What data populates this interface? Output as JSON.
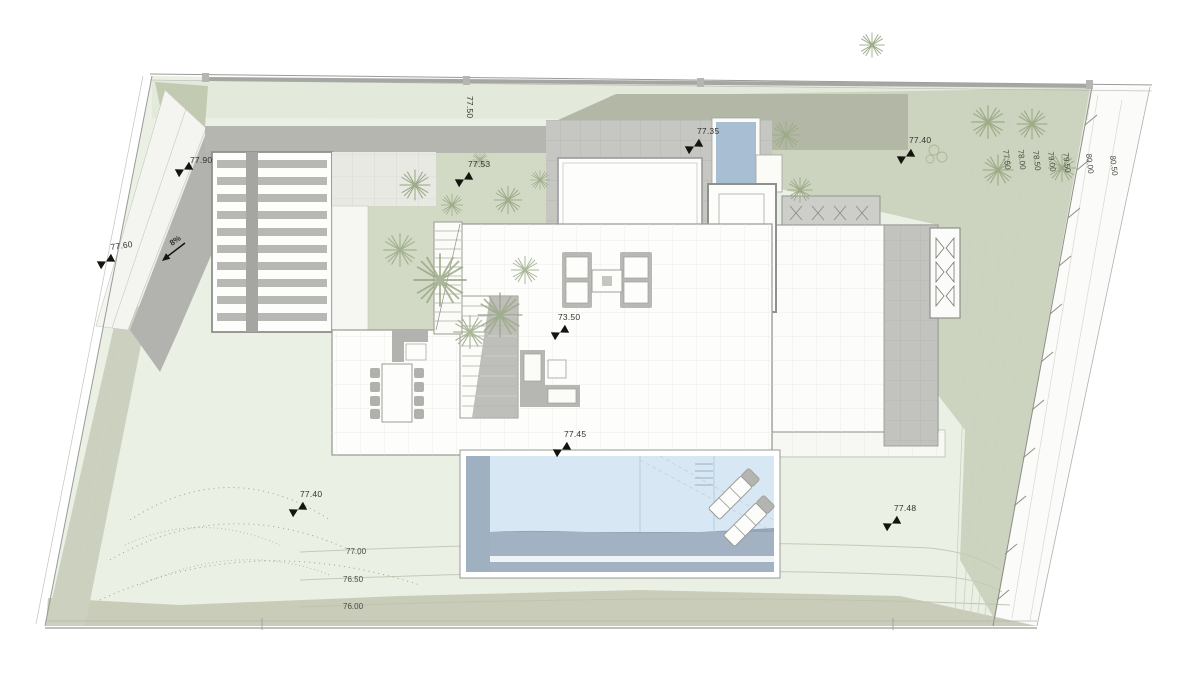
{
  "drawing": {
    "type": "architectural-site-plan",
    "street_level_label": "77.50",
    "slope_label": "8%",
    "spot_elevations": [
      {
        "label": "77.90"
      },
      {
        "label": "77.60"
      },
      {
        "label": "77.53"
      },
      {
        "label": "77.35"
      },
      {
        "label": "77.40"
      },
      {
        "label": "73.50"
      },
      {
        "label": "77.45"
      },
      {
        "label": "77.40"
      },
      {
        "label": "77.48"
      }
    ],
    "contour_labels_bottom": [
      {
        "label": "77.00"
      },
      {
        "label": "76.50"
      },
      {
        "label": "76.00"
      }
    ],
    "contour_labels_right": [
      {
        "label": "77.50"
      },
      {
        "label": "78.00"
      },
      {
        "label": "78.50"
      },
      {
        "label": "79.00"
      },
      {
        "label": "79.50"
      },
      {
        "label": "80.00"
      },
      {
        "label": "80.50"
      }
    ],
    "colors": {
      "lawn": "#eaf0e4",
      "lawn_top": "#e3eadb",
      "sage": "#ccd3bf",
      "courtyard": "#d2dac6",
      "water": "#d7e8f4",
      "water_deep": "#a2b2c2",
      "water_lap": "#a8bed2",
      "terrace": "#c6c6c2",
      "structure_gray": "#b6b6b1",
      "ink": "#2e2e2a"
    }
  }
}
